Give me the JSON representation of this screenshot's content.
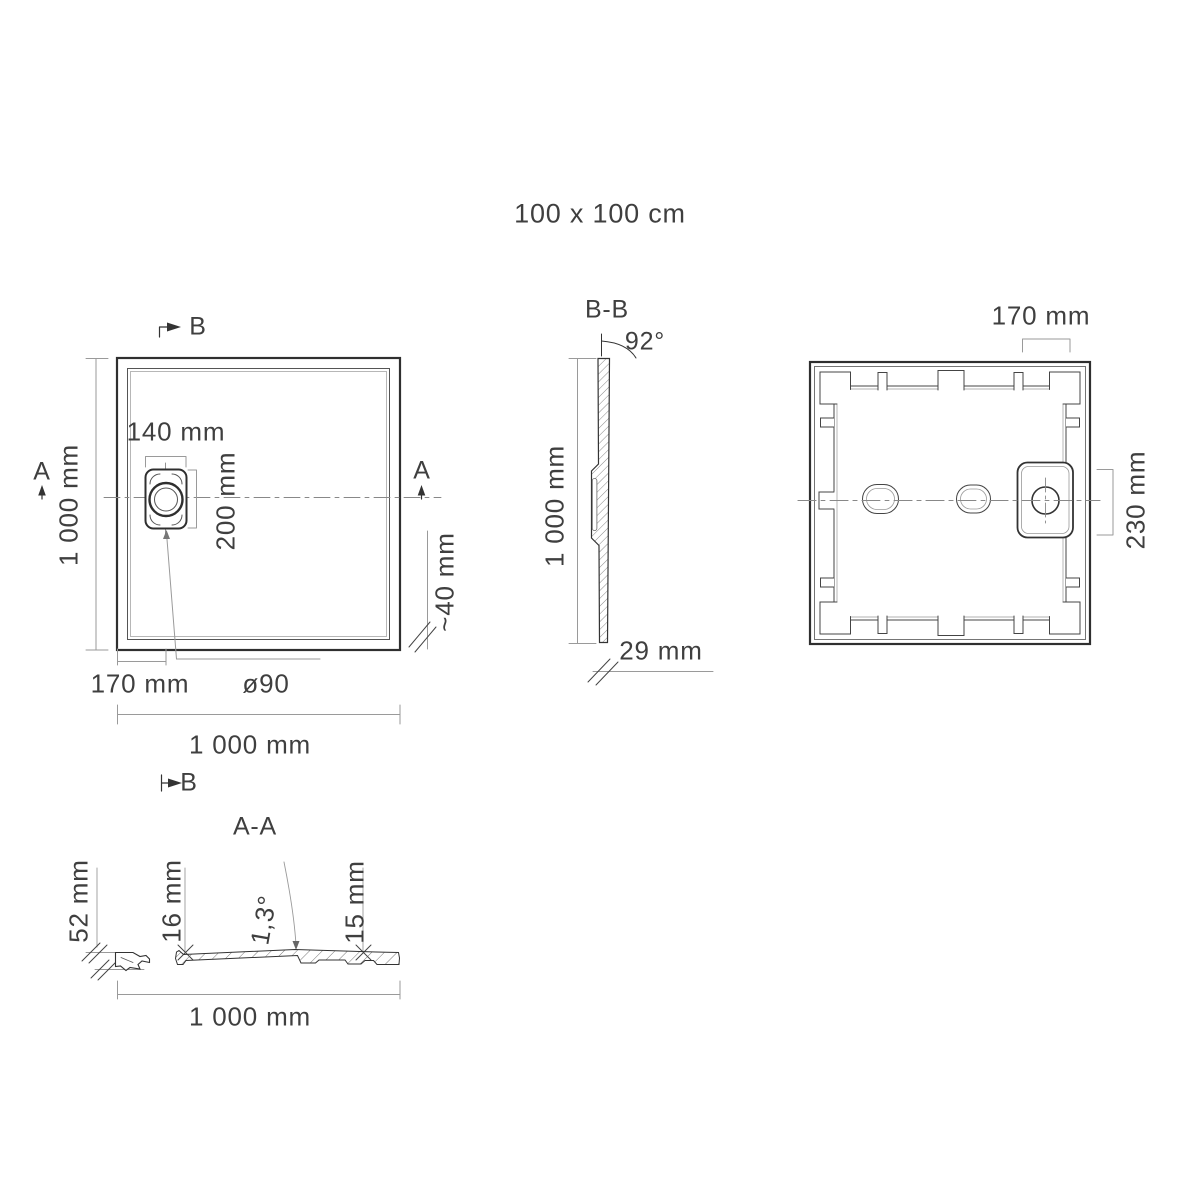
{
  "title": "100 x 100 cm",
  "colors": {
    "line": "#333333",
    "dim": "#9a9a9a",
    "text": "#3f3f3f",
    "background": "#ffffff"
  },
  "plan_view": {
    "marker_top": "B",
    "marker_bottom": "B",
    "marker_left": "A",
    "marker_right": "A",
    "drain_width": "140 mm",
    "drain_height": "200 mm",
    "side_length": "1 000 mm",
    "drain_offset": "170 mm",
    "drain_diameter": "ø90",
    "width": "1 000 mm",
    "depth": "~40 mm"
  },
  "section_bb": {
    "label": "B-B",
    "wall_angle": "92°",
    "length": "1 000 mm",
    "thickness": "29 mm"
  },
  "bottom_view": {
    "recess_top": "170 mm",
    "recess_side": "230 mm"
  },
  "section_aa": {
    "label": "A-A",
    "total_height": "52 mm",
    "thickness_left": "16 mm",
    "slope": "1,3°",
    "thickness_right": "15 mm",
    "width": "1 000 mm"
  }
}
